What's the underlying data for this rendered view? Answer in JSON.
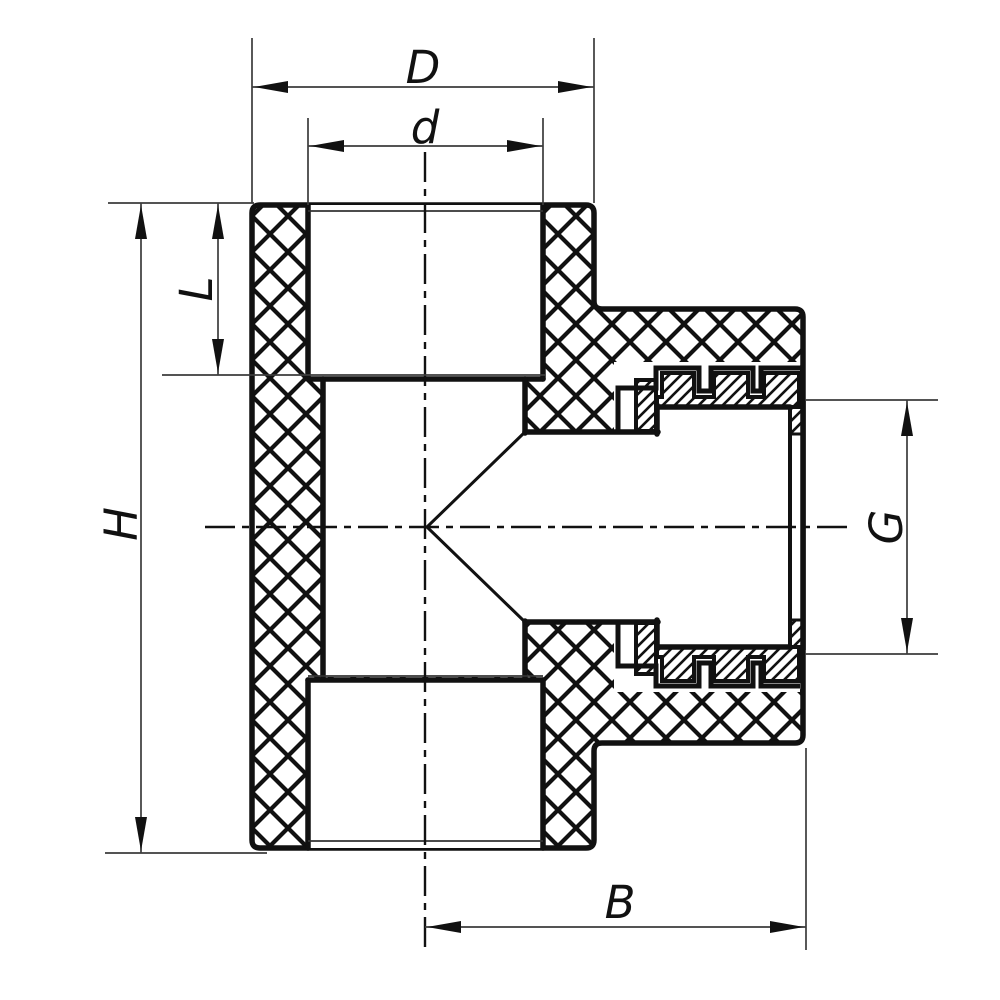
{
  "page": {
    "background": "#ffffff"
  },
  "drawing": {
    "title": "Sectional dimension drawing of a PPR tee fitting with female threaded branch",
    "line_color": "#111111",
    "dimension_line_color": "#3c3c3c",
    "hatch_styles": {
      "polymer_body": "cross-hatch",
      "threaded_insert": "diagonal-hatch"
    },
    "dimensions": [
      {
        "id": "outer-diameter",
        "label": "D"
      },
      {
        "id": "bore-diameter",
        "label": "d"
      },
      {
        "id": "socket-depth",
        "label": "L"
      },
      {
        "id": "body-height",
        "label": "H"
      },
      {
        "id": "thread-size",
        "label": "G"
      },
      {
        "id": "branch-length",
        "label": "B"
      }
    ]
  }
}
